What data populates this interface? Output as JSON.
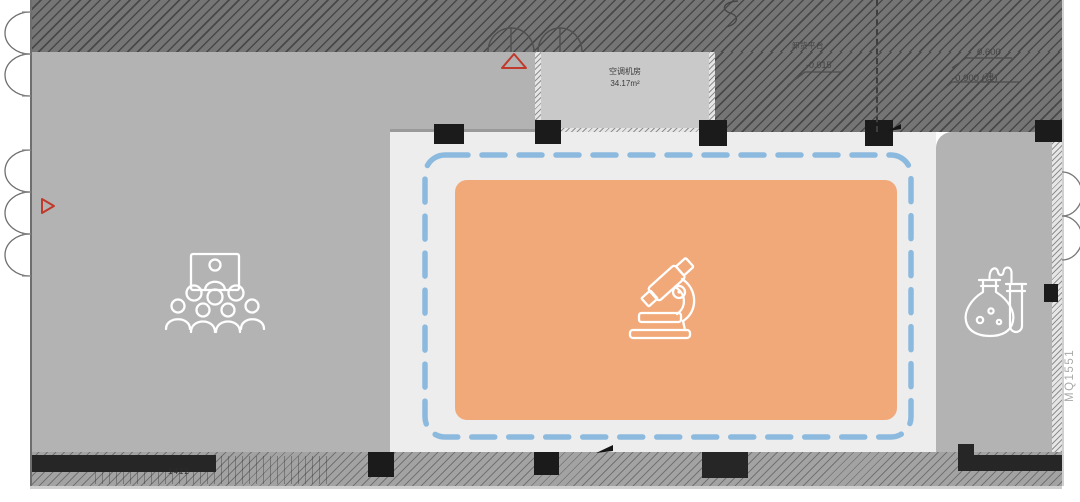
{
  "drawing": {
    "type": "architectural-floor-plan",
    "rooms": {
      "ac_room": {
        "name": "空调机房",
        "area": "34.17m²"
      },
      "training_area": {
        "icon": "audience-presentation-icon"
      },
      "lab_highlight": {
        "icon": "microscope-icon"
      },
      "chem_area": {
        "icon": "lab-flask-icon"
      }
    },
    "annotations": {
      "platform_label": "卸货平台",
      "platform_elevation": "-0.015",
      "elevation_upper": "0.600",
      "elevation_lower": "-0.900 (建)",
      "bottom_dimension": "1412",
      "curtain_wall_tag": "MQ1551"
    },
    "colors": {
      "hatch_fill": "#757575",
      "room_gray": "#b3b3b3",
      "ac_room_fill": "#c9c9c9",
      "lab_floor": "#ededed",
      "highlight_fill": "#f2a97a",
      "boundary_dash": "#8cbade",
      "marker_red": "#c0392b",
      "column_black": "#1b1b1b",
      "icon_stroke": "#ffffff"
    }
  }
}
